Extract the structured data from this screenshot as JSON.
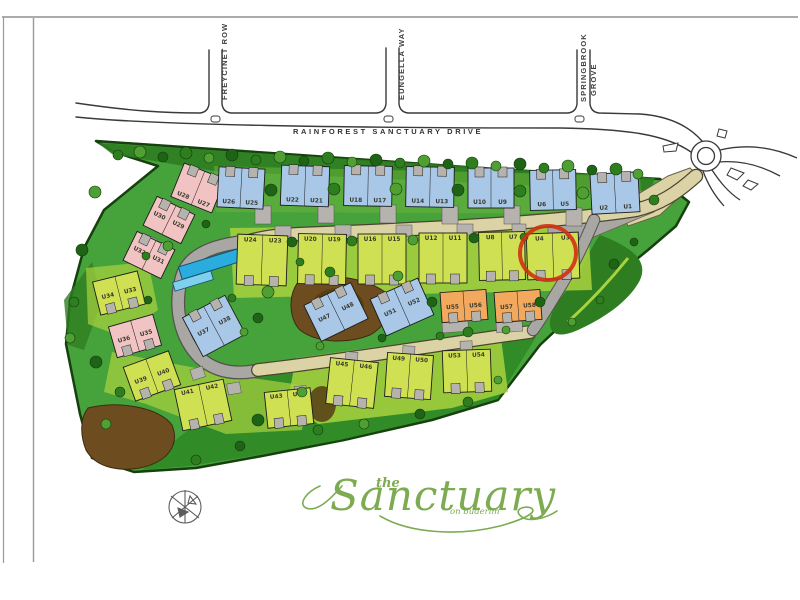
{
  "page": {
    "background": "#ffffff",
    "frame_color": "#8f8f8f"
  },
  "streets": {
    "main": {
      "label": "RAINFOREST   SANCTUARY   DRIVE"
    },
    "side": [
      {
        "label": "FREYCINET ROW"
      },
      {
        "label": "EUNGELLA WAY"
      },
      {
        "label": "SPRINGBROOK GROVE",
        "lines": [
          "SPRINGBROOK",
          "GROVE"
        ]
      }
    ]
  },
  "logo": {
    "the": "the",
    "name": "Sanctuary",
    "tagline": "on buderim",
    "color": "#7cab51"
  },
  "map": {
    "colors": {
      "blue": "#a9c7e6",
      "yellow": "#cfe052",
      "pink": "#f1c3c3",
      "orange": "#f2a95e",
      "garage": "#b6b3ae",
      "site": "#46a33c",
      "site_dark": "#2e7d20",
      "lawn": "#a9d23f",
      "road_tan": "#dbd2a6",
      "road_gray": "#a9a7a3",
      "pool": "#2bacdf",
      "mulch": "#6d4c20",
      "highlight": "#d03014",
      "tree_dark": "#1f6316",
      "tree_mid": "#2e7d1f",
      "tree_light": "#4f9f33",
      "ink": "#2b2b2b"
    },
    "highlight": {
      "unit": "U4",
      "cx": 548,
      "cy": 253,
      "rx": 28,
      "ry": 27
    },
    "buildings": [
      {
        "l": [
          "U28",
          "U27"
        ],
        "x": 176,
        "y": 170,
        "w": 44,
        "h": 36,
        "r": 22,
        "c": "pink",
        "lp": "bottom",
        "g": "top"
      },
      {
        "l": [
          "U26",
          "U25"
        ],
        "x": 218,
        "y": 168,
        "w": 46,
        "h": 40,
        "r": 3,
        "c": "blue",
        "lp": "bottom",
        "g": "top"
      },
      {
        "l": [
          "U22",
          "U21"
        ],
        "x": 281,
        "y": 166,
        "w": 48,
        "h": 40,
        "r": 2,
        "c": "blue",
        "lp": "bottom",
        "g": "top"
      },
      {
        "l": [
          "U18",
          "U17"
        ],
        "x": 344,
        "y": 166,
        "w": 48,
        "h": 40,
        "r": 1,
        "c": "blue",
        "lp": "bottom",
        "g": "top"
      },
      {
        "l": [
          "U14",
          "U13"
        ],
        "x": 406,
        "y": 167,
        "w": 48,
        "h": 40,
        "r": 1,
        "c": "blue",
        "lp": "bottom",
        "g": "top"
      },
      {
        "l": [
          "U10",
          "U9"
        ],
        "x": 468,
        "y": 168,
        "w": 46,
        "h": 40,
        "r": 0,
        "c": "blue",
        "lp": "bottom",
        "g": "top"
      },
      {
        "l": [
          "U6",
          "U5"
        ],
        "x": 530,
        "y": 170,
        "w": 46,
        "h": 40,
        "r": -1,
        "c": "blue",
        "lp": "bottom",
        "g": "top"
      },
      {
        "l": [
          "U2",
          "U1"
        ],
        "x": 591,
        "y": 173,
        "w": 48,
        "h": 40,
        "r": -3,
        "c": "blue",
        "lp": "bottom",
        "g": "top"
      },
      {
        "l": [
          "U24",
          "U23"
        ],
        "x": 237,
        "y": 235,
        "w": 50,
        "h": 50,
        "r": 2,
        "c": "yellow",
        "lp": "top",
        "g": "bottom"
      },
      {
        "l": [
          "U20",
          "U19"
        ],
        "x": 298,
        "y": 234,
        "w": 48,
        "h": 50,
        "r": 1,
        "c": "yellow",
        "lp": "top",
        "g": "bottom"
      },
      {
        "l": [
          "U16",
          "U15"
        ],
        "x": 358,
        "y": 234,
        "w": 48,
        "h": 50,
        "r": 0,
        "c": "yellow",
        "lp": "top",
        "g": "bottom"
      },
      {
        "l": [
          "U12",
          "U11"
        ],
        "x": 419,
        "y": 233,
        "w": 48,
        "h": 50,
        "r": 0,
        "c": "yellow",
        "lp": "top",
        "g": "bottom"
      },
      {
        "l": [
          "U8",
          "U7"
        ],
        "x": 479,
        "y": 232,
        "w": 46,
        "h": 48,
        "r": -1,
        "c": "yellow",
        "lp": "top",
        "g": "bottom"
      },
      {
        "l": [
          "U4",
          "U3"
        ],
        "x": 527,
        "y": 233,
        "w": 52,
        "h": 46,
        "r": -2,
        "c": "yellow",
        "lp": "top",
        "g": "bottom"
      },
      {
        "l": [
          "U30",
          "U29"
        ],
        "x": 148,
        "y": 204,
        "w": 42,
        "h": 32,
        "r": 26,
        "c": "pink",
        "lp": "mid",
        "g": "top"
      },
      {
        "l": [
          "U32",
          "U31"
        ],
        "x": 128,
        "y": 239,
        "w": 42,
        "h": 32,
        "r": 26,
        "c": "pink",
        "lp": "mid",
        "g": "top"
      },
      {
        "l": [
          "U34",
          "U33"
        ],
        "x": 96,
        "y": 276,
        "w": 46,
        "h": 34,
        "r": -14,
        "c": "yellow",
        "lp": "mid",
        "g": "bottom"
      },
      {
        "l": [
          "U36",
          "U35"
        ],
        "x": 112,
        "y": 320,
        "w": 46,
        "h": 32,
        "r": -16,
        "c": "pink",
        "lp": "mid",
        "g": "bottom"
      },
      {
        "l": [
          "U37",
          "U38"
        ],
        "x": 190,
        "y": 304,
        "w": 48,
        "h": 44,
        "r": -28,
        "c": "blue",
        "lp": "mid",
        "g": "top"
      },
      {
        "l": [
          "U39",
          "U40"
        ],
        "x": 128,
        "y": 358,
        "w": 48,
        "h": 36,
        "r": -20,
        "c": "yellow",
        "lp": "mid",
        "g": "bottom"
      },
      {
        "l": [
          "U41",
          "U42"
        ],
        "x": 178,
        "y": 384,
        "w": 50,
        "h": 42,
        "r": -12,
        "c": "yellow",
        "lp": "top",
        "g": "bottom"
      },
      {
        "l": [
          "U43",
          "U44"
        ],
        "x": 266,
        "y": 390,
        "w": 46,
        "h": 36,
        "r": -6,
        "c": "yellow",
        "lp": "top",
        "g": "bottom"
      },
      {
        "l": [
          "U45",
          "U46"
        ],
        "x": 328,
        "y": 360,
        "w": 48,
        "h": 46,
        "r": 6,
        "c": "yellow",
        "lp": "top",
        "g": "bottom"
      },
      {
        "l": [
          "U49",
          "U50"
        ],
        "x": 386,
        "y": 354,
        "w": 46,
        "h": 44,
        "r": 4,
        "c": "yellow",
        "lp": "top",
        "g": "bottom"
      },
      {
        "l": [
          "U53",
          "U54"
        ],
        "x": 443,
        "y": 350,
        "w": 48,
        "h": 42,
        "r": -2,
        "c": "yellow",
        "lp": "top",
        "g": "bottom"
      },
      {
        "l": [
          "U47",
          "U48"
        ],
        "x": 310,
        "y": 292,
        "w": 52,
        "h": 40,
        "r": -26,
        "c": "blue",
        "lp": "mid",
        "g": "top"
      },
      {
        "l": [
          "U51",
          "U52"
        ],
        "x": 376,
        "y": 287,
        "w": 52,
        "h": 40,
        "r": -24,
        "c": "blue",
        "lp": "mid",
        "g": "top"
      },
      {
        "l": [
          "U55",
          "U56"
        ],
        "x": 441,
        "y": 291,
        "w": 46,
        "h": 30,
        "r": -4,
        "c": "orange",
        "lp": "mid",
        "g": "bottom"
      },
      {
        "l": [
          "U57",
          "U58"
        ],
        "x": 495,
        "y": 291,
        "w": 46,
        "h": 30,
        "r": -4,
        "c": "orange",
        "lp": "mid",
        "g": "bottom"
      }
    ],
    "pads": [
      [
        263,
        206,
        16,
        18,
        0
      ],
      [
        326,
        205,
        16,
        18,
        0
      ],
      [
        388,
        205,
        16,
        18,
        0
      ],
      [
        450,
        206,
        16,
        18,
        0
      ],
      [
        512,
        206,
        16,
        18,
        0
      ],
      [
        574,
        208,
        16,
        18,
        0
      ],
      [
        283,
        226,
        16,
        11,
        0
      ],
      [
        343,
        225,
        16,
        11,
        0
      ],
      [
        404,
        225,
        16,
        11,
        0
      ],
      [
        465,
        224,
        16,
        11,
        0
      ],
      [
        519,
        224,
        14,
        11,
        0
      ],
      [
        352,
        352,
        12,
        10,
        4
      ],
      [
        409,
        346,
        12,
        10,
        3
      ],
      [
        466,
        341,
        12,
        10,
        -2
      ],
      [
        455,
        322,
        26,
        10,
        -4
      ],
      [
        509,
        322,
        26,
        10,
        -4
      ],
      [
        196,
        368,
        13,
        11,
        -18
      ],
      [
        233,
        383,
        13,
        11,
        -10
      ],
      [
        300,
        386,
        12,
        10,
        -6
      ],
      [
        152,
        237,
        13,
        11,
        26
      ],
      [
        171,
        208,
        13,
        11,
        24
      ],
      [
        340,
        310,
        14,
        12,
        -26
      ],
      [
        406,
        304,
        14,
        12,
        -25
      ]
    ],
    "trees": [
      [
        118,
        155,
        5
      ],
      [
        140,
        152,
        6
      ],
      [
        163,
        157,
        5
      ],
      [
        186,
        153,
        6
      ],
      [
        209,
        158,
        5
      ],
      [
        232,
        155,
        6
      ],
      [
        256,
        160,
        5
      ],
      [
        280,
        157,
        6
      ],
      [
        304,
        161,
        5
      ],
      [
        328,
        158,
        6
      ],
      [
        352,
        162,
        5
      ],
      [
        376,
        160,
        6
      ],
      [
        400,
        163,
        5
      ],
      [
        424,
        161,
        6
      ],
      [
        448,
        164,
        5
      ],
      [
        472,
        163,
        6
      ],
      [
        496,
        166,
        5
      ],
      [
        520,
        164,
        6
      ],
      [
        544,
        168,
        5
      ],
      [
        568,
        166,
        6
      ],
      [
        592,
        170,
        5
      ],
      [
        616,
        169,
        6
      ],
      [
        638,
        174,
        5
      ],
      [
        271,
        190,
        6
      ],
      [
        334,
        189,
        6
      ],
      [
        396,
        189,
        6
      ],
      [
        458,
        190,
        6
      ],
      [
        520,
        191,
        6
      ],
      [
        583,
        193,
        6
      ],
      [
        292,
        242,
        5
      ],
      [
        352,
        241,
        5
      ],
      [
        413,
        240,
        5
      ],
      [
        474,
        238,
        5
      ],
      [
        524,
        237,
        4
      ],
      [
        268,
        292,
        6
      ],
      [
        258,
        318,
        5
      ],
      [
        330,
        272,
        5
      ],
      [
        398,
        276,
        5
      ],
      [
        432,
        302,
        5
      ],
      [
        468,
        332,
        5
      ],
      [
        506,
        330,
        4
      ],
      [
        540,
        302,
        5
      ],
      [
        300,
        262,
        4
      ],
      [
        320,
        346,
        4
      ],
      [
        382,
        338,
        4
      ],
      [
        440,
        336,
        4
      ],
      [
        302,
        392,
        5
      ],
      [
        258,
        420,
        6
      ],
      [
        318,
        430,
        5
      ],
      [
        364,
        424,
        5
      ],
      [
        420,
        414,
        5
      ],
      [
        468,
        402,
        5
      ],
      [
        498,
        380,
        4
      ],
      [
        240,
        446,
        5
      ],
      [
        196,
        460,
        5
      ],
      [
        95,
        192,
        6
      ],
      [
        82,
        250,
        6
      ],
      [
        74,
        302,
        5
      ],
      [
        70,
        338,
        5
      ],
      [
        96,
        362,
        6
      ],
      [
        120,
        392,
        5
      ],
      [
        106,
        424,
        5
      ],
      [
        148,
        300,
        4
      ],
      [
        146,
        256,
        4
      ],
      [
        168,
        246,
        5
      ],
      [
        206,
        224,
        4
      ],
      [
        232,
        298,
        4
      ],
      [
        244,
        332,
        4
      ],
      [
        614,
        264,
        5
      ],
      [
        600,
        300,
        4
      ],
      [
        572,
        322,
        4
      ],
      [
        634,
        242,
        4
      ],
      [
        654,
        200,
        5
      ]
    ]
  }
}
